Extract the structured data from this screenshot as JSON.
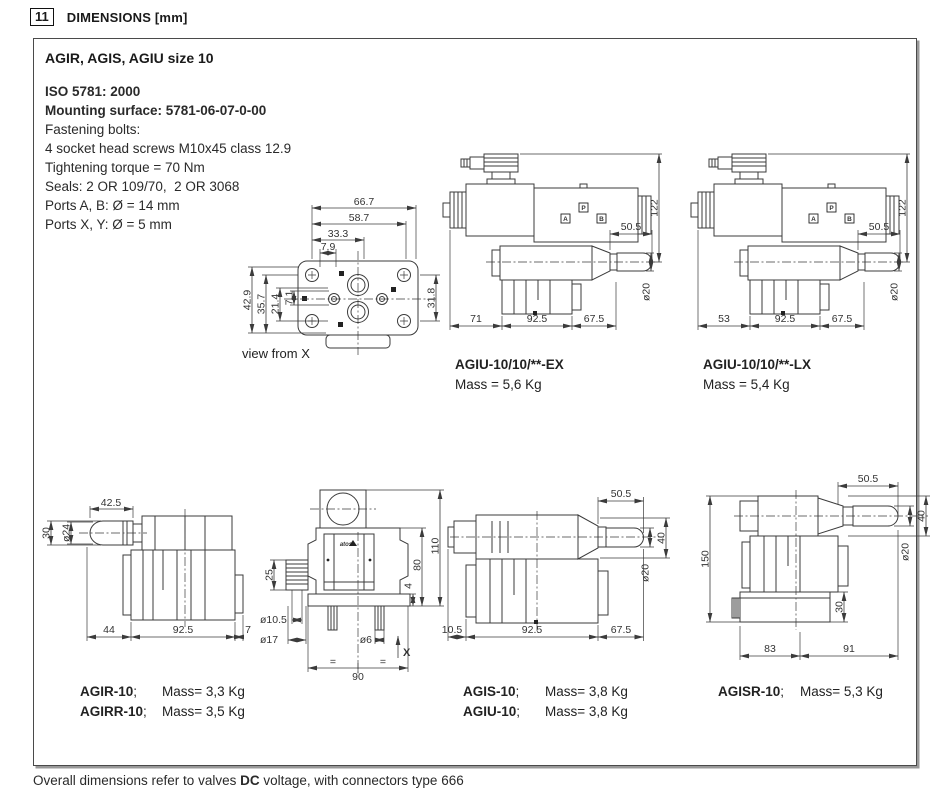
{
  "header": {
    "section_number": "11",
    "title": "DIMENSIONS [mm]"
  },
  "panel_title": "AGIR, AGIS, AGIU size 10",
  "specs": {
    "line1": "ISO 5781: 2000",
    "line2": "Mounting surface: 5781-06-07-0-00",
    "line3": "Fastening bolts:",
    "line4": "4 socket head screws M10x45 class 12.9",
    "line5": "Tightening torque = 70 Nm",
    "line6": "Seals: 2 OR 109/70,  2 OR 3068",
    "line7": "Ports A, B: Ø = 14 mm",
    "line8": "Ports X, Y: Ø = 5 mm"
  },
  "view_from_x": {
    "caption": "view from X",
    "dims": {
      "w1": "66.7",
      "w2": "58.7",
      "w3": "33.3",
      "w4": "7.9",
      "v1": "7.1",
      "v2": "21.4",
      "v3": "35.7",
      "v4": "42.9",
      "right": "31.8"
    }
  },
  "agiu_ex": {
    "model": "AGIU-10/10/**-EX",
    "mass": "Mass = 5,6 Kg",
    "ports": {
      "a": "A",
      "p": "P",
      "b": "B"
    },
    "dims": {
      "handle": "50.5",
      "height": "122",
      "dia": "ø20",
      "b1": "71",
      "b2": "92.5",
      "b3": "67.5"
    }
  },
  "agiu_lx": {
    "model": "AGIU-10/10/**-LX",
    "mass": "Mass = 5,4 Kg",
    "ports": {
      "a": "A",
      "p": "P",
      "b": "B"
    },
    "dims": {
      "handle": "50.5",
      "height": "122",
      "dia": "ø20",
      "b1": "53",
      "b2": "92.5",
      "b3": "67.5"
    }
  },
  "agir_drawing": {
    "dims": {
      "handle": "42.5",
      "h": "30",
      "dia": "ø24",
      "b1": "44",
      "b2": "92.5",
      "b3": "7"
    }
  },
  "front_view": {
    "logo": "atos",
    "axis_label": "X",
    "dims": {
      "total_h": "110",
      "body_h": "80",
      "stack": "25",
      "plate": "4",
      "dia1": "ø10.5",
      "dia2": "ø17",
      "dia3": "ø6",
      "width": "90",
      "eq": "="
    }
  },
  "agis_drawing": {
    "dims": {
      "handle": "50.5",
      "h": "40",
      "dia": "ø20",
      "b1": "10.5",
      "b2": "92.5",
      "b3": "67.5"
    }
  },
  "agisr_drawing": {
    "dims": {
      "handle": "50.5",
      "h": "40",
      "dia": "ø20",
      "height": "150",
      "foot": "30",
      "b1": "83",
      "b2": "91"
    }
  },
  "model_captions": {
    "separator": ";",
    "rows_left": [
      {
        "model": "AGIR-10",
        "mass": "Mass= 3,3 Kg"
      },
      {
        "model": "AGIRR-10",
        "mass": "Mass= 3,5 Kg"
      }
    ],
    "rows_mid": [
      {
        "model": "AGIS-10",
        "mass": "Mass= 3,8 Kg"
      },
      {
        "model": "AGIU-10",
        "mass": "Mass= 3,8 Kg"
      }
    ],
    "rows_right": [
      {
        "model": "AGISR-10",
        "mass": "Mass= 5,3 Kg"
      }
    ]
  },
  "footer": {
    "text_before": "Overall dimensions refer to valves ",
    "bold": "DC",
    "text_after": " voltage, with connectors type 666"
  }
}
